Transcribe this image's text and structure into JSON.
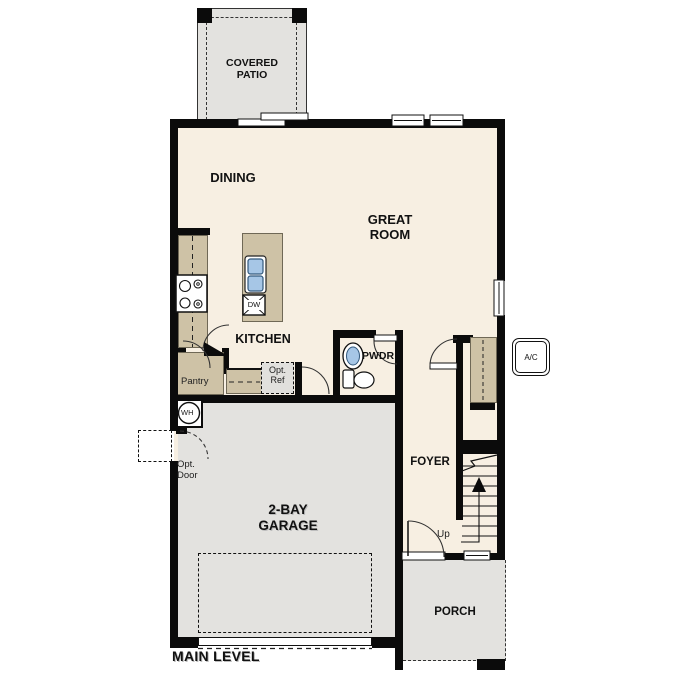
{
  "title": "MAIN LEVEL",
  "colors": {
    "wall": "#0b0b0b",
    "interior_floor": "#f7efe2",
    "outdoor_floor": "#e3e2df",
    "cabinet_tan": "#cec2a6",
    "fixture_blue": "#a6c6e6"
  },
  "rooms": {
    "covered_patio": "COVERED\nPATIO",
    "dining": "DINING",
    "great_room": "GREAT\nROOM",
    "kitchen": "KITCHEN",
    "powder": "PWDR",
    "foyer": "FOYER",
    "garage": "2-BAY\nGARAGE",
    "porch": "PORCH"
  },
  "features": {
    "pantry": "Pantry",
    "opt_ref": "Opt.\nRef",
    "opt_door": "Opt.\nDoor",
    "water_heater": "WH",
    "dishwasher": "DW",
    "stairs_up": "Up",
    "ac_unit": "A/C"
  }
}
